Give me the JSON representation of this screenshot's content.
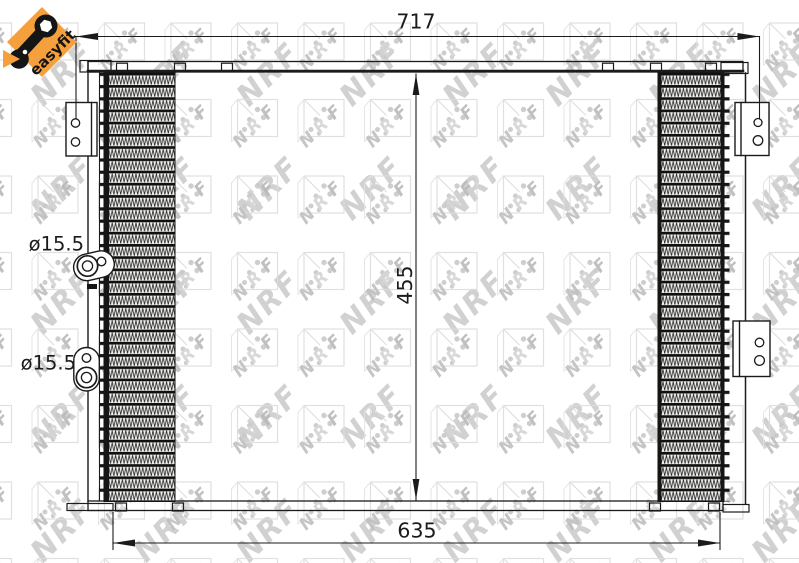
{
  "badge": {
    "label": "easyfit"
  },
  "watermark": {
    "text": "NRF",
    "letters": [
      "N",
      "R",
      "F"
    ]
  },
  "dimensions": {
    "top_width": "717",
    "height": "455",
    "bottom_width": "635",
    "upper_port": "ø15.5",
    "lower_port": "ø15.5"
  },
  "colors": {
    "badge_orange": "#F5A03C",
    "line": "#1b1b1b",
    "watermark_gray": "#c9c9c9"
  }
}
